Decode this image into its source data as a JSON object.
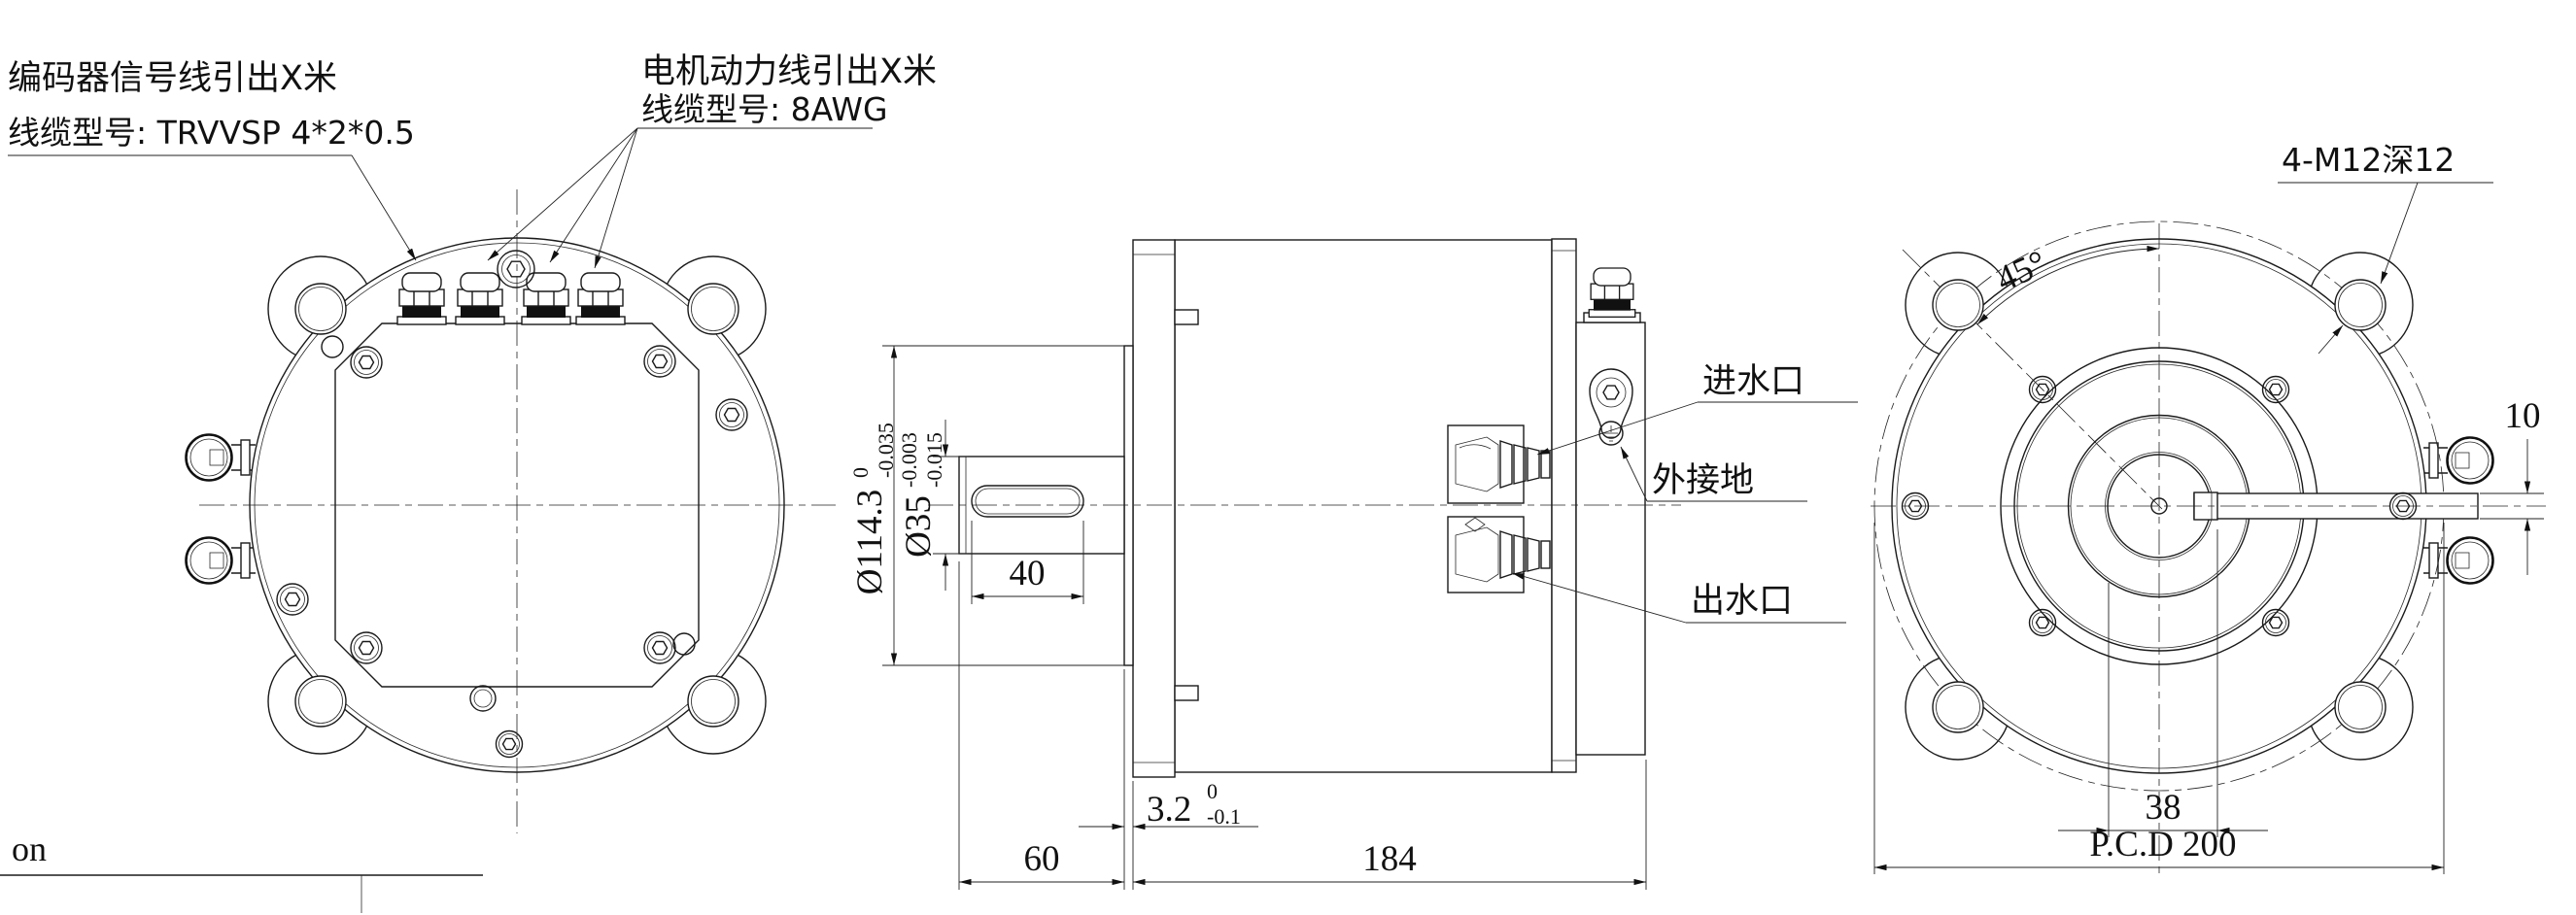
{
  "page": {
    "background": "#ffffff",
    "line_color": "#1a1a1a"
  },
  "labels": {
    "encoder_cable": {
      "line1": "编码器信号线引出X米",
      "line2": "线缆型号: TRVVSP 4*2*0.5"
    },
    "power_cable": {
      "line1": "电机动力线引出X米",
      "line2": "线缆型号: 8AWG"
    },
    "water_inlet": "进水口",
    "external_ground": "外接地",
    "water_outlet": "出水口",
    "mounting_holes": "4-M12深12",
    "corner_text": "on"
  },
  "dimensions": {
    "pilot_diameter": {
      "value": "Ø114.3",
      "tol_upper": "0",
      "tol_lower": "-0.035"
    },
    "shaft_diameter": {
      "value": "Ø35",
      "tol_upper": "-0.003",
      "tol_lower": "-0.015"
    },
    "keyway_length": "40",
    "spigot_protrusion": {
      "value": "3.2",
      "tol_upper": "0",
      "tol_lower": "-0.1"
    },
    "shaft_extension": "60",
    "body_length": "184",
    "key_width": "10",
    "key_length": "38",
    "pitch_circle_diameter": "P.C.D 200",
    "ear_angle": "45°"
  }
}
